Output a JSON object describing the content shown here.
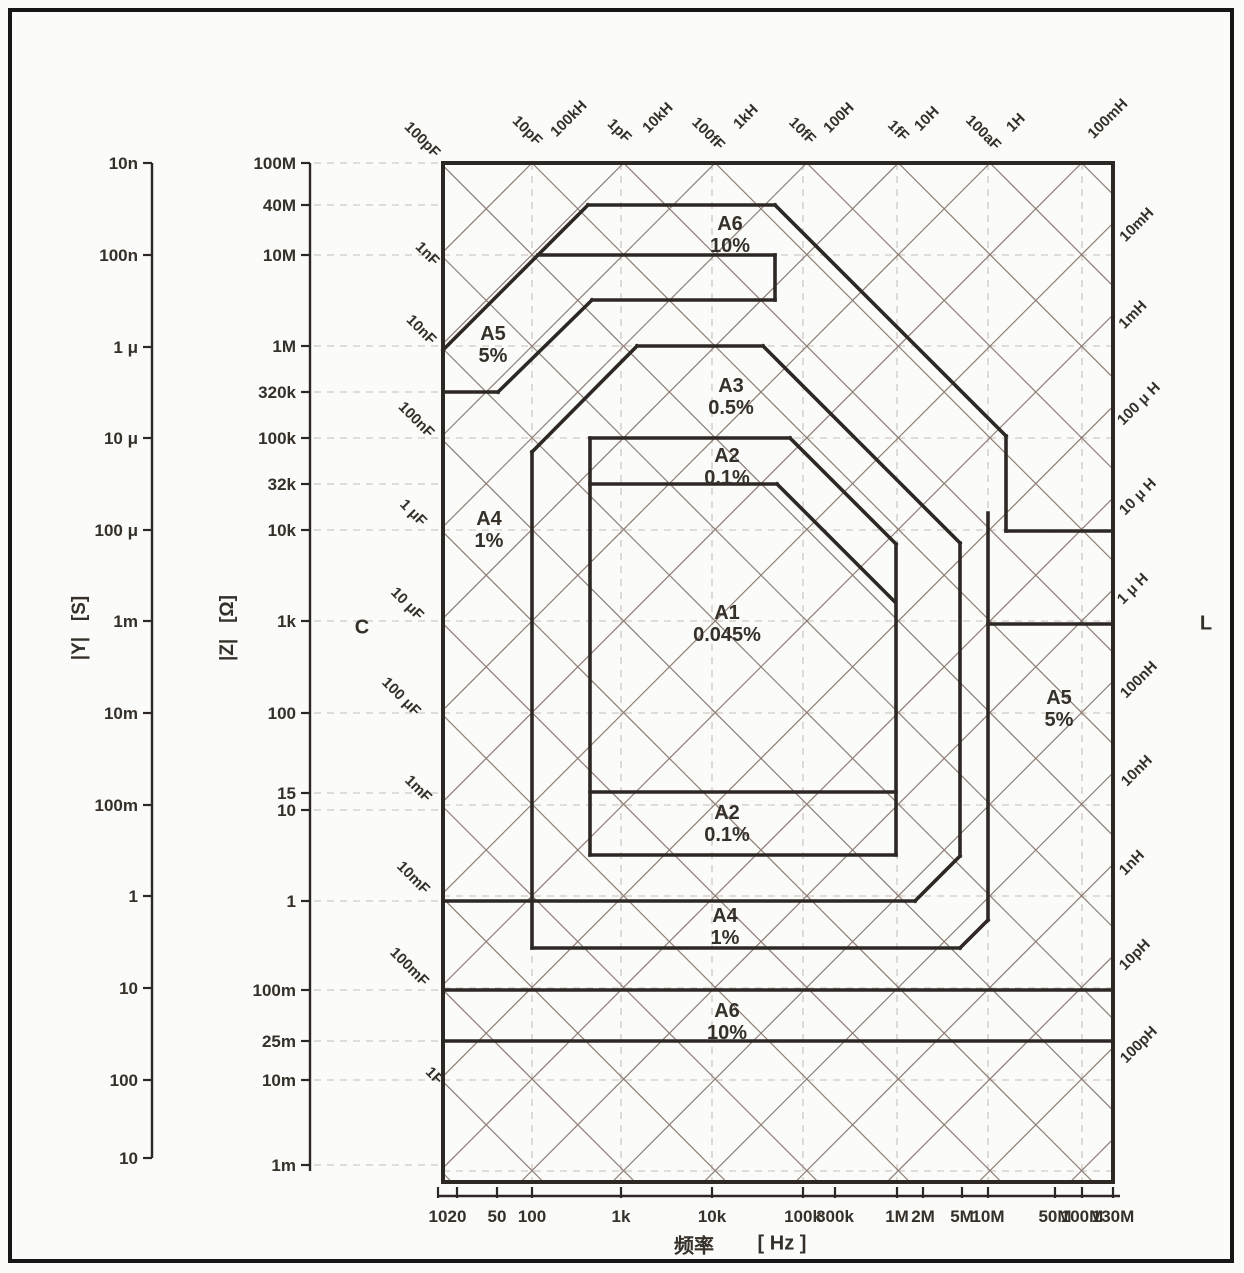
{
  "colors": {
    "line_dark": "#2e2824",
    "grid_diagonal": "#8d7d75",
    "grid_dashed": "#cfcac4",
    "text": "#353029",
    "background": "#fbfbf9",
    "frame_border": "#161616"
  },
  "axis_titles": {
    "admittance": "|Y|   [S]",
    "impedance": "|Z|   [Ω]",
    "capacitance_corner": "C",
    "inductance_corner": "L",
    "frequency_cjk": "频率",
    "frequency_unit": "[ Hz ]"
  },
  "chart_data": {
    "type": "area",
    "title": "LCR impedance measurement accuracy regions (|Z| vs frequency)",
    "plot": {
      "x1": 443,
      "y1": 163,
      "x2": 1113,
      "y2": 1182
    },
    "frequency_axis": {
      "label": "频率 [ Hz ]",
      "y": 1196,
      "x1": 437,
      "x2": 1120,
      "ticks": [
        {
          "label": "10",
          "x": 438
        },
        {
          "label": "20",
          "x": 457
        },
        {
          "label": "50",
          "x": 497
        },
        {
          "label": "100",
          "x": 532
        },
        {
          "label": "1k",
          "x": 621
        },
        {
          "label": "10k",
          "x": 712
        },
        {
          "label": "100k",
          "x": 803
        },
        {
          "label": "300k",
          "x": 835
        },
        {
          "label": "1M",
          "x": 897
        },
        {
          "label": "2M",
          "x": 923
        },
        {
          "label": "5M",
          "x": 962
        },
        {
          "label": "10M",
          "x": 988
        },
        {
          "label": "50M",
          "x": 1055
        },
        {
          "label": "100M",
          "x": 1082
        },
        {
          "label": "130M",
          "x": 1113
        }
      ]
    },
    "impedance_axis": {
      "label": "|Z| [Ω]",
      "x": 310,
      "y1": 163,
      "y2": 1171,
      "ticks": [
        {
          "label": "100M",
          "y": 163
        },
        {
          "label": "40M",
          "y": 205
        },
        {
          "label": "10M",
          "y": 255
        },
        {
          "label": "1M",
          "y": 346
        },
        {
          "label": "320k",
          "y": 392
        },
        {
          "label": "100k",
          "y": 438
        },
        {
          "label": "32k",
          "y": 484
        },
        {
          "label": "10k",
          "y": 530
        },
        {
          "label": "1k",
          "y": 621
        },
        {
          "label": "100",
          "y": 713
        },
        {
          "label": "15",
          "y": 793
        },
        {
          "label": "10",
          "y": 810
        },
        {
          "label": "1",
          "y": 901
        },
        {
          "label": "100m",
          "y": 990
        },
        {
          "label": "25m",
          "y": 1041
        },
        {
          "label": "10m",
          "y": 1080
        },
        {
          "label": "1m",
          "y": 1165
        }
      ]
    },
    "admittance_axis": {
      "label": "|Y| [S]",
      "x": 152,
      "y1": 163,
      "y2": 1158,
      "ticks": [
        {
          "label": "10n",
          "y": 163
        },
        {
          "label": "100n",
          "y": 255
        },
        {
          "label": "1 μ",
          "y": 347
        },
        {
          "label": "10 μ",
          "y": 438
        },
        {
          "label": "100 μ",
          "y": 530
        },
        {
          "label": "1m",
          "y": 621
        },
        {
          "label": "10m",
          "y": 713
        },
        {
          "label": "100m",
          "y": 805
        },
        {
          "label": "1",
          "y": 896
        },
        {
          "label": "10",
          "y": 988
        },
        {
          "label": "100",
          "y": 1080
        },
        {
          "label": "10",
          "y": 1158
        }
      ]
    },
    "regions": [
      {
        "name": "A6",
        "accuracy": "10%",
        "x": 730,
        "y": 224
      },
      {
        "name": "A5",
        "accuracy": "5%",
        "x": 493,
        "y": 334
      },
      {
        "name": "A3",
        "accuracy": "0.5%",
        "x": 731,
        "y": 386
      },
      {
        "name": "A2",
        "accuracy": "0.1%",
        "x": 727,
        "y": 456
      },
      {
        "name": "A4",
        "accuracy": "1%",
        "x": 489,
        "y": 519
      },
      {
        "name": "A1",
        "accuracy": "0.045%",
        "x": 727,
        "y": 613
      },
      {
        "name": "A5",
        "accuracy": "5%",
        "x": 1059,
        "y": 698
      },
      {
        "name": "A2",
        "accuracy": "0.1%",
        "x": 727,
        "y": 813
      },
      {
        "name": "A4",
        "accuracy": "1%",
        "x": 725,
        "y": 916
      },
      {
        "name": "A6",
        "accuracy": "10%",
        "x": 727,
        "y": 1011
      }
    ],
    "boundary_segments": [
      [
        588,
        205,
        775,
        205
      ],
      [
        538,
        255,
        775,
        255
      ],
      [
        592,
        300,
        775,
        300
      ],
      [
        637,
        346,
        763,
        346
      ],
      [
        590,
        438,
        790,
        438
      ],
      [
        590,
        484,
        777,
        484
      ],
      [
        1006,
        531,
        1113,
        531
      ],
      [
        988,
        624,
        1113,
        624
      ],
      [
        590,
        792,
        896,
        792
      ],
      [
        590,
        855,
        896,
        855
      ],
      [
        443,
        901,
        915,
        901
      ],
      [
        532,
        948,
        960,
        948
      ],
      [
        443,
        990,
        1113,
        990
      ],
      [
        443,
        1041,
        1113,
        1041
      ],
      [
        443,
        392,
        498,
        392
      ],
      [
        590,
        438,
        590,
        855
      ],
      [
        896,
        544,
        896,
        855
      ],
      [
        532,
        452,
        532,
        948
      ],
      [
        988,
        513,
        988,
        920
      ],
      [
        1006,
        436,
        1006,
        531
      ],
      [
        775,
        255,
        775,
        300
      ],
      [
        960,
        543,
        960,
        856
      ],
      [
        443,
        350,
        588,
        205
      ],
      [
        498,
        392,
        592,
        300
      ],
      [
        532,
        452,
        637,
        346
      ],
      [
        775,
        205,
        1006,
        436
      ],
      [
        763,
        346,
        960,
        543
      ],
      [
        790,
        438,
        896,
        544
      ],
      [
        777,
        484,
        895,
        602
      ],
      [
        915,
        901,
        960,
        856
      ],
      [
        960,
        948,
        988,
        920
      ]
    ],
    "grid": {
      "diagonal_spacing": 91.6,
      "c_family_anchor": 695,
      "l_family_anchor": -369,
      "dashed_vertical_x": [
        532,
        621,
        712,
        803,
        897,
        988,
        1082
      ],
      "dashed_horizontal_y": [
        255,
        346,
        438,
        530,
        621,
        713,
        805,
        896,
        988,
        1080,
        1171
      ]
    },
    "capacitance_labels_top": [
      {
        "label": "100pF",
        "x": 419,
        "y": 143
      },
      {
        "label": "10pF",
        "x": 524,
        "y": 134
      },
      {
        "label": "1pF",
        "x": 616,
        "y": 134
      },
      {
        "label": "100fF",
        "x": 705,
        "y": 137
      },
      {
        "label": "10fF",
        "x": 799,
        "y": 134
      },
      {
        "label": "1fF",
        "x": 895,
        "y": 134
      },
      {
        "label": "100aF",
        "x": 980,
        "y": 136
      }
    ],
    "inductance_labels_top": [
      {
        "label": "100kH",
        "x": 572,
        "y": 122
      },
      {
        "label": "10kH",
        "x": 661,
        "y": 121
      },
      {
        "label": "1kH",
        "x": 749,
        "y": 120
      },
      {
        "label": "100H",
        "x": 842,
        "y": 121
      },
      {
        "label": "10H",
        "x": 930,
        "y": 122
      },
      {
        "label": "1H",
        "x": 1019,
        "y": 126
      },
      {
        "label": "100mH",
        "x": 1111,
        "y": 122
      }
    ],
    "capacitance_labels_left": [
      {
        "label": "1nF",
        "x": 424,
        "y": 257
      },
      {
        "label": "10nF",
        "x": 418,
        "y": 333
      },
      {
        "label": "100nF",
        "x": 413,
        "y": 423
      },
      {
        "label": "1 μF",
        "x": 410,
        "y": 516
      },
      {
        "label": "10 μF",
        "x": 404,
        "y": 607
      },
      {
        "label": "100 μF",
        "x": 398,
        "y": 700
      },
      {
        "label": "1mF",
        "x": 415,
        "y": 792
      },
      {
        "label": "10mF",
        "x": 410,
        "y": 881
      },
      {
        "label": "100mF",
        "x": 406,
        "y": 970
      },
      {
        "label": "1F",
        "x": 431,
        "y": 1079
      }
    ],
    "inductance_labels_right": [
      {
        "label": "10mH",
        "x": 1140,
        "y": 228
      },
      {
        "label": "1mH",
        "x": 1136,
        "y": 318
      },
      {
        "label": "100 μ H",
        "x": 1142,
        "y": 407
      },
      {
        "label": "10 μ H",
        "x": 1141,
        "y": 500
      },
      {
        "label": "1 μ H",
        "x": 1136,
        "y": 592
      },
      {
        "label": "100nH",
        "x": 1142,
        "y": 683
      },
      {
        "label": "10nH",
        "x": 1140,
        "y": 774
      },
      {
        "label": "1nH",
        "x": 1135,
        "y": 866
      },
      {
        "label": "10pH",
        "x": 1138,
        "y": 958
      },
      {
        "label": "100pH",
        "x": 1142,
        "y": 1048
      }
    ]
  }
}
